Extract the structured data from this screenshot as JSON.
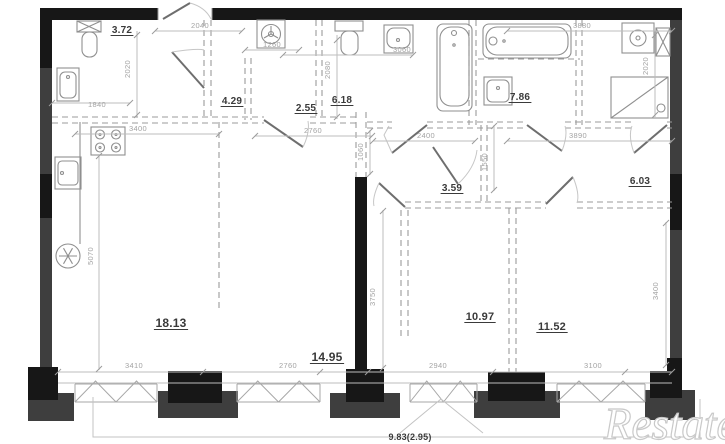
{
  "watermark": "Restate",
  "rooms": [
    {
      "name": "wc",
      "area": "3.72",
      "x": 122,
      "y": 33,
      "size": 10,
      "underline": true
    },
    {
      "name": "hallway",
      "area": "4.29",
      "x": 232,
      "y": 104,
      "size": 10,
      "underline": true
    },
    {
      "name": "closet",
      "area": "2.55",
      "x": 306,
      "y": 111,
      "size": 10,
      "underline": true
    },
    {
      "name": "bathroom",
      "area": "6.18",
      "x": 342,
      "y": 103,
      "size": 10,
      "underline": true
    },
    {
      "name": "bathroom-2",
      "area": "7.86",
      "x": 520,
      "y": 100,
      "size": 10,
      "underline": true
    },
    {
      "name": "hall",
      "area": "3.59",
      "x": 452,
      "y": 191,
      "size": 10,
      "underline": true
    },
    {
      "name": "wardrobe",
      "area": "6.03",
      "x": 640,
      "y": 184,
      "size": 10,
      "underline": true
    },
    {
      "name": "kitchen-living",
      "area": "18.13",
      "x": 171,
      "y": 327,
      "size": 12,
      "underline": true
    },
    {
      "name": "living-zone",
      "area": "14.95",
      "x": 327,
      "y": 361,
      "size": 12,
      "underline": true
    },
    {
      "name": "bedroom-1",
      "area": "10.97",
      "x": 480,
      "y": 320,
      "size": 11,
      "underline": true
    },
    {
      "name": "bedroom-2",
      "area": "11.52",
      "x": 552,
      "y": 330,
      "size": 11,
      "underline": true
    },
    {
      "name": "balcony",
      "area": "9.83(2.95)",
      "x": 410,
      "y": 440,
      "size": 9,
      "underline": false
    }
  ],
  "dimensions_mm": [
    {
      "value": "2040",
      "x": 200,
      "y": 28,
      "rotate": false
    },
    {
      "value": "1840",
      "x": 97,
      "y": 107,
      "rotate": false
    },
    {
      "value": "2020",
      "x": 130,
      "y": 69,
      "rotate": true
    },
    {
      "value": "3400",
      "x": 138,
      "y": 131,
      "rotate": false
    },
    {
      "value": "1260",
      "x": 272,
      "y": 47,
      "rotate": false
    },
    {
      "value": "3060",
      "x": 402,
      "y": 52,
      "rotate": false
    },
    {
      "value": "2080",
      "x": 330,
      "y": 70,
      "rotate": true
    },
    {
      "value": "2760",
      "x": 313,
      "y": 133,
      "rotate": false
    },
    {
      "value": "3880",
      "x": 582,
      "y": 28,
      "rotate": false
    },
    {
      "value": "2020",
      "x": 648,
      "y": 66,
      "rotate": true
    },
    {
      "value": "2400",
      "x": 426,
      "y": 138,
      "rotate": false
    },
    {
      "value": "3890",
      "x": 578,
      "y": 138,
      "rotate": false
    },
    {
      "value": "1060",
      "x": 363,
      "y": 152,
      "rotate": true
    },
    {
      "value": "1550",
      "x": 487,
      "y": 162,
      "rotate": true
    },
    {
      "value": "5070",
      "x": 93,
      "y": 256,
      "rotate": true
    },
    {
      "value": "3750",
      "x": 375,
      "y": 297,
      "rotate": true
    },
    {
      "value": "3400",
      "x": 658,
      "y": 291,
      "rotate": true
    },
    {
      "value": "3410",
      "x": 134,
      "y": 368,
      "rotate": false
    },
    {
      "value": "2760",
      "x": 288,
      "y": 368,
      "rotate": false
    },
    {
      "value": "2940",
      "x": 438,
      "y": 368,
      "rotate": false
    },
    {
      "value": "3100",
      "x": 593,
      "y": 368,
      "rotate": false
    }
  ]
}
